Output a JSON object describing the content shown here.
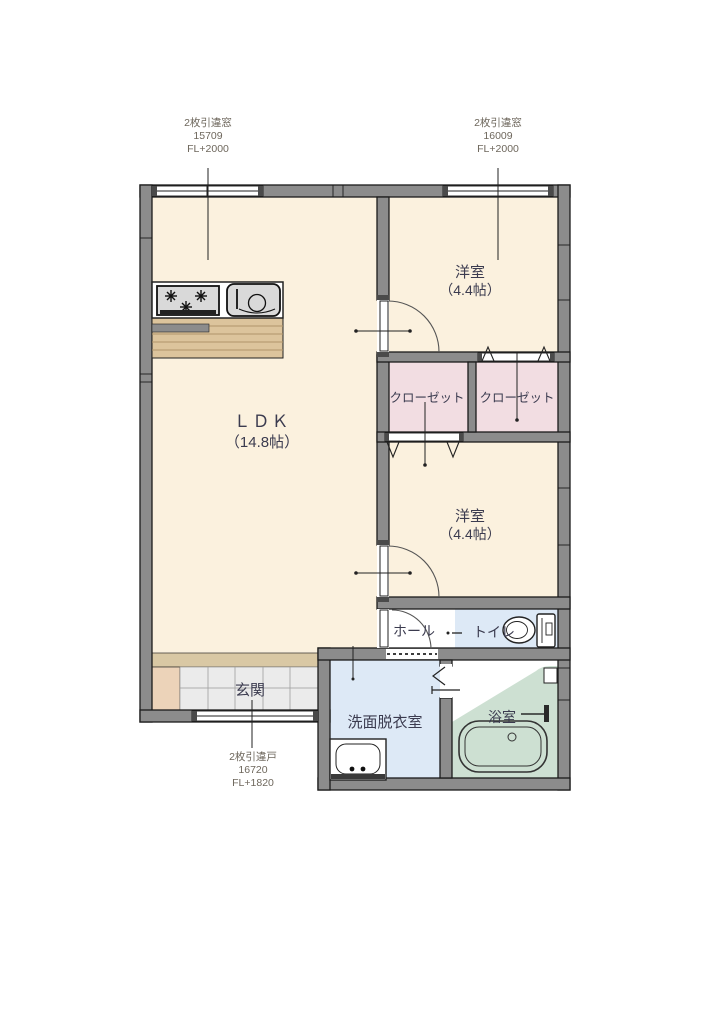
{
  "page": {
    "background": "#ffffff"
  },
  "plan": {
    "rooms": {
      "ldk": {
        "label": "ＬＤＫ",
        "area": "（14.8帖）"
      },
      "bedroom_top": {
        "label": "洋室",
        "area": "（4.4帖）"
      },
      "bedroom_bottom": {
        "label": "洋室",
        "area": "（4.4帖）"
      },
      "closet_left": {
        "label": "クローゼット"
      },
      "closet_right": {
        "label": "クローゼット"
      },
      "hall": {
        "label": "ホール"
      },
      "toilet": {
        "label": "トイレ"
      },
      "washroom": {
        "label": "洗面脱衣室"
      },
      "bathroom": {
        "label": "浴室"
      },
      "entrance": {
        "label": "玄関"
      }
    },
    "annotations": {
      "window_left": {
        "type": "2枚引違窓",
        "code": "15709",
        "level": "FL+2000"
      },
      "window_right": {
        "type": "2枚引違窓",
        "code": "16009",
        "level": "FL+2000"
      },
      "entry_door": {
        "type": "2枚引違戸",
        "code": "16720",
        "level": "FL+1820"
      }
    },
    "colors": {
      "floor_cream": "#fbf1de",
      "wall_gray": "#8c8c8c",
      "closet_pink": "#f2dde2",
      "water_blue": "#dde9f6",
      "bath_green": "#cde0d2",
      "wood_tan": "#dcc49c",
      "entrance_tile": "#ebebeb",
      "cabinet_beige": "#ecd3b9",
      "step_tan": "#d9c8a4"
    }
  }
}
